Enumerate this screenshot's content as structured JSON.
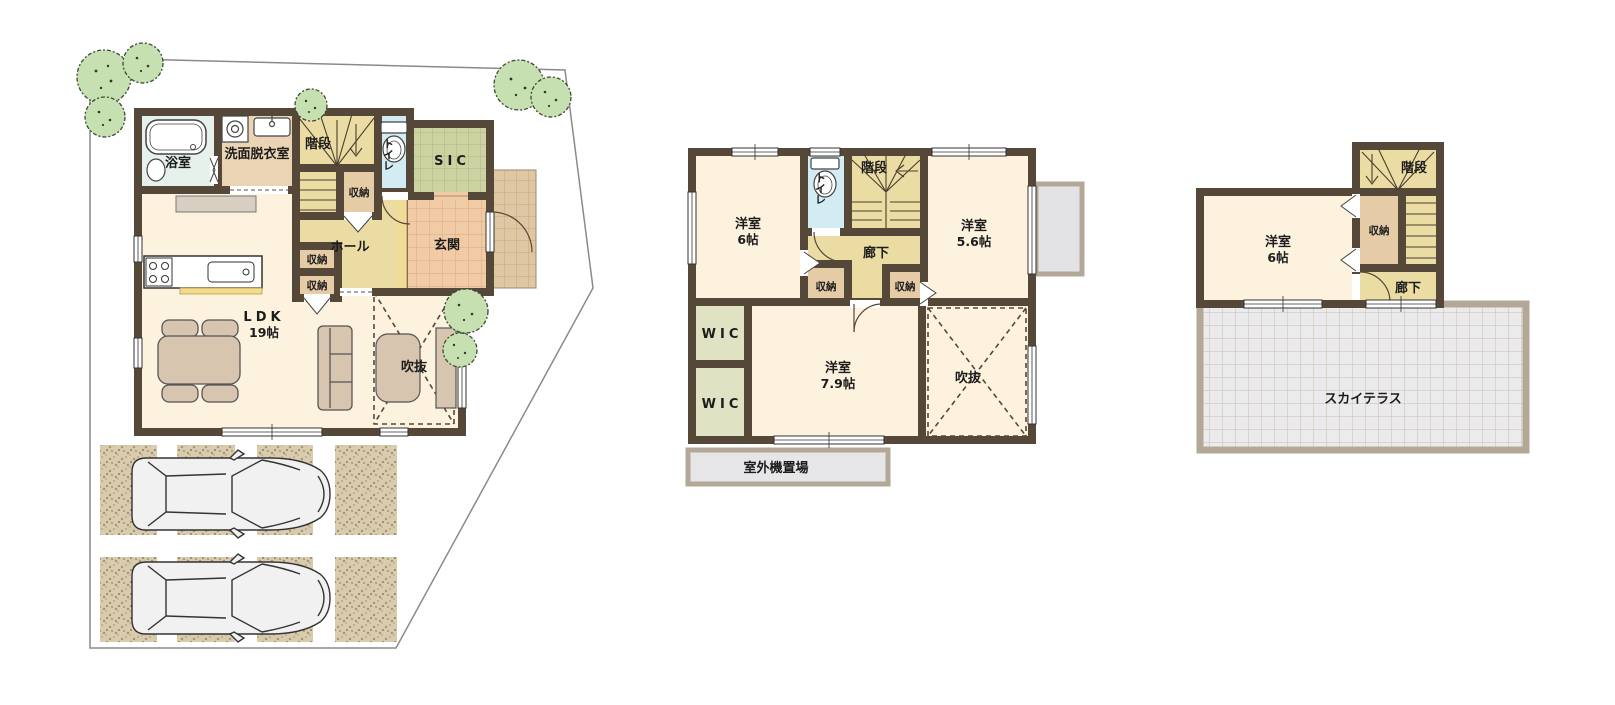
{
  "colors": {
    "wall": "#564838",
    "room_cream": "#fdf2de",
    "hall_yellow": "#ebdca4",
    "storage_tan": "#e5cba6",
    "washroom_tan": "#ead4b4",
    "toilet_blue": "#d3ebf2",
    "bath_mint": "#e6f1ec",
    "sic_green": "#ccd2a2",
    "entrance_salmon": "#f0cba6",
    "porch_tan": "#dec7a2",
    "wic_green": "#dfe3c3",
    "terrace_gray": "#ebebee",
    "outdoor_gray": "#e6e6e8",
    "tree_green": "#c7e0b2",
    "gravel_tan": "#d8cbae",
    "furniture_tan": "#d7c5af"
  },
  "floor1": {
    "bath": "浴室",
    "washroom": "洗面脱衣室",
    "stairs": "階段",
    "storage_a": "収納",
    "toilet": "トイレ",
    "sic": "SIC",
    "entrance": "玄関",
    "hall": "ホール",
    "storage_b": "収納",
    "storage_c": "収納",
    "ldk": "LDK",
    "ldk_size": "19帖",
    "void": "吹抜"
  },
  "floor2": {
    "room_a": "洋室",
    "room_a_size": "6帖",
    "toilet": "トイレ",
    "stairs": "階段",
    "room_b": "洋室",
    "room_b_size": "5.6帖",
    "corridor": "廊下",
    "storage_a": "収納",
    "storage_b": "収納",
    "wic_a": "WIC",
    "wic_b": "WIC",
    "room_c": "洋室",
    "room_c_size": "7.9帖",
    "void": "吹抜",
    "outdoor_unit": "室外機置場"
  },
  "floor3": {
    "stairs": "階段",
    "storage": "収納",
    "room": "洋室",
    "room_size": "6帖",
    "corridor": "廊下",
    "terrace": "スカイテラス"
  }
}
